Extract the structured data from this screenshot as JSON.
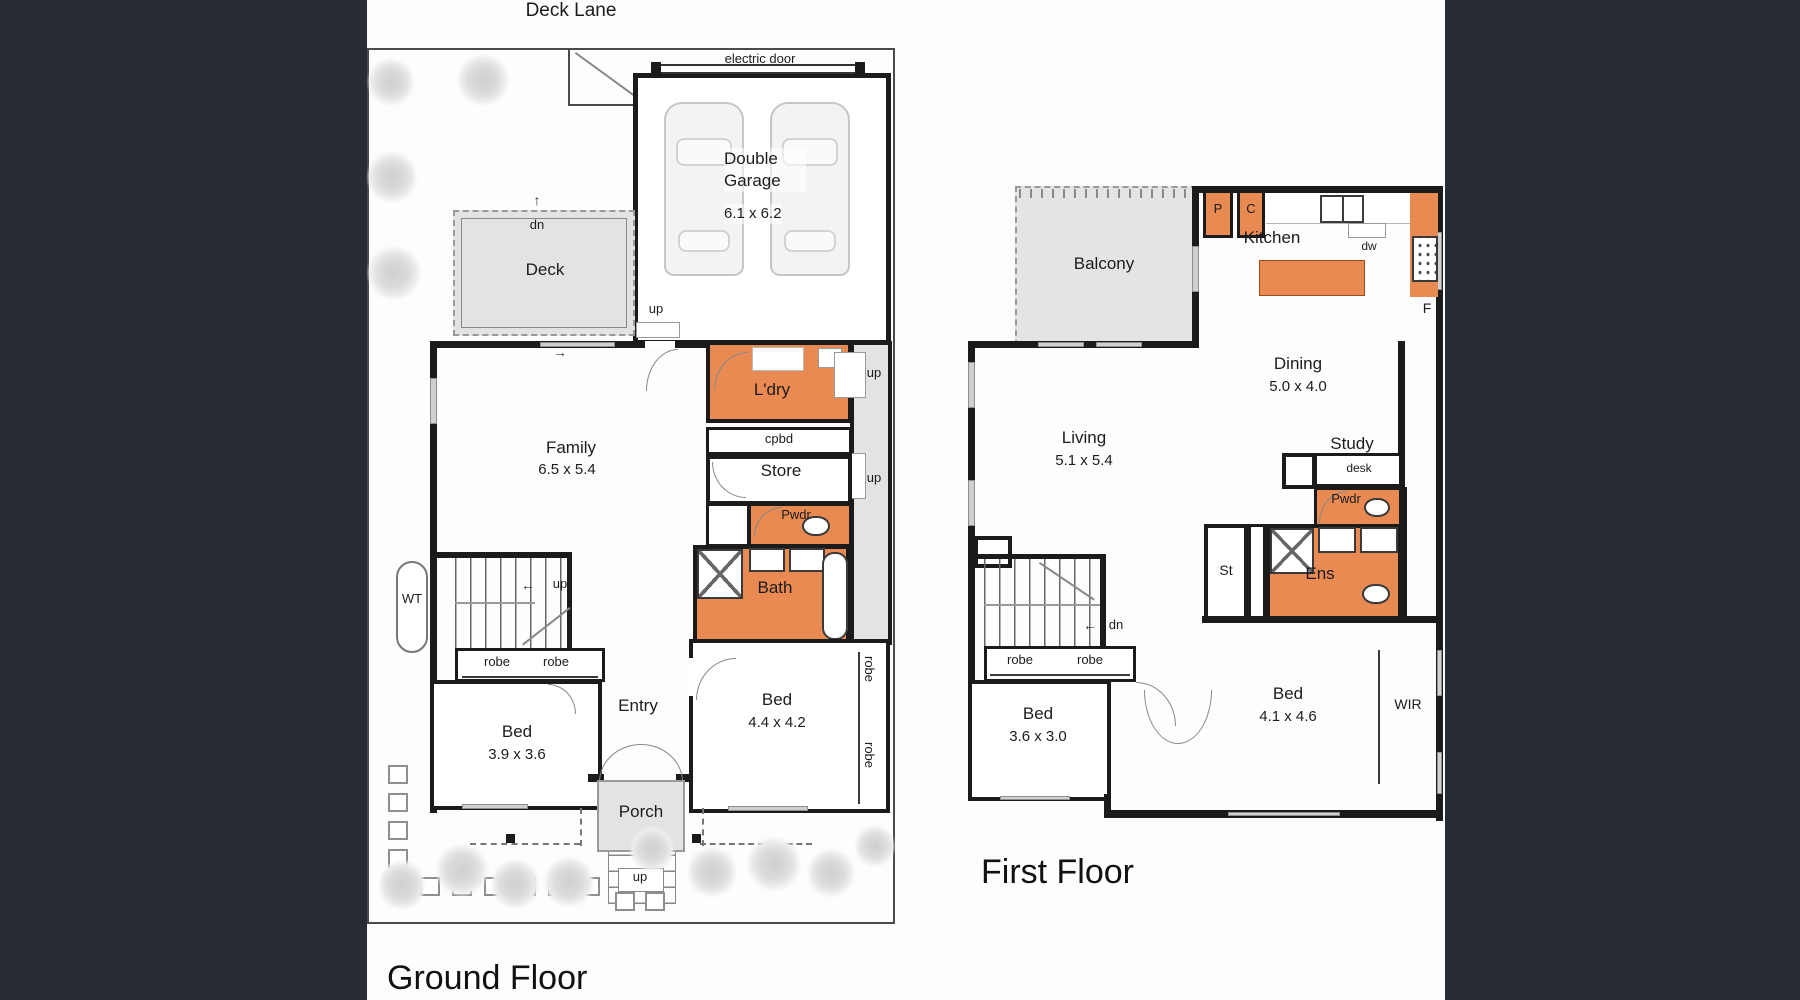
{
  "colors": {
    "accent_orange": "#E88A52",
    "room_gray": "#E3E3E3",
    "wall_black": "#1B1B1B",
    "panel_dark": "#272C35",
    "tree_gray": "#D8D8D8"
  },
  "icons": {
    "arrow_up": "↑",
    "arrow_left": "←",
    "arrow_right": "→"
  },
  "ground_floor": {
    "title": "Ground Floor",
    "lane": "Deck Lane",
    "electric_door": "electric door",
    "garage": "Double Garage",
    "garage_dims": "6.1 x 6.2",
    "deck": "Deck",
    "deck_stair": "dn",
    "family": "Family",
    "family_dims": "6.5 x 5.4",
    "laundry": "L'dry",
    "cupboard": "cpbd",
    "store": "Store",
    "powder": "Pwdr",
    "bath": "Bath",
    "water_tank": "WT",
    "stair_up": "up",
    "door_up_top": "up",
    "door_up_side1": "up",
    "door_up_side2": "up",
    "robe_a": "robe",
    "robe_b": "robe",
    "robe_c": "robe",
    "robe_d": "robe",
    "bed1": "Bed",
    "bed1_dims": "3.9 x 3.6",
    "entry": "Entry",
    "bed2": "Bed",
    "bed2_dims": "4.4 x 4.2",
    "porch": "Porch",
    "porch_stair": "up"
  },
  "first_floor": {
    "title": "First Floor",
    "balcony": "Balcony",
    "pantry": "P",
    "cupboard": "C",
    "kitchen": "Kitchen",
    "dishwasher": "dw",
    "fridge": "F",
    "dining": "Dining",
    "dining_dims": "5.0 x 4.0",
    "living": "Living",
    "living_dims": "5.1 x 5.4",
    "study": "Study",
    "desk": "desk",
    "powder": "Pwdr",
    "store": "St",
    "ensuite": "Ens",
    "stair_down": "dn",
    "robe_a": "robe",
    "robe_b": "robe",
    "bed3": "Bed",
    "bed3_dims": "3.6 x 3.0",
    "bed4": "Bed",
    "bed4_dims": "4.1 x 4.6",
    "wir": "WIR"
  }
}
